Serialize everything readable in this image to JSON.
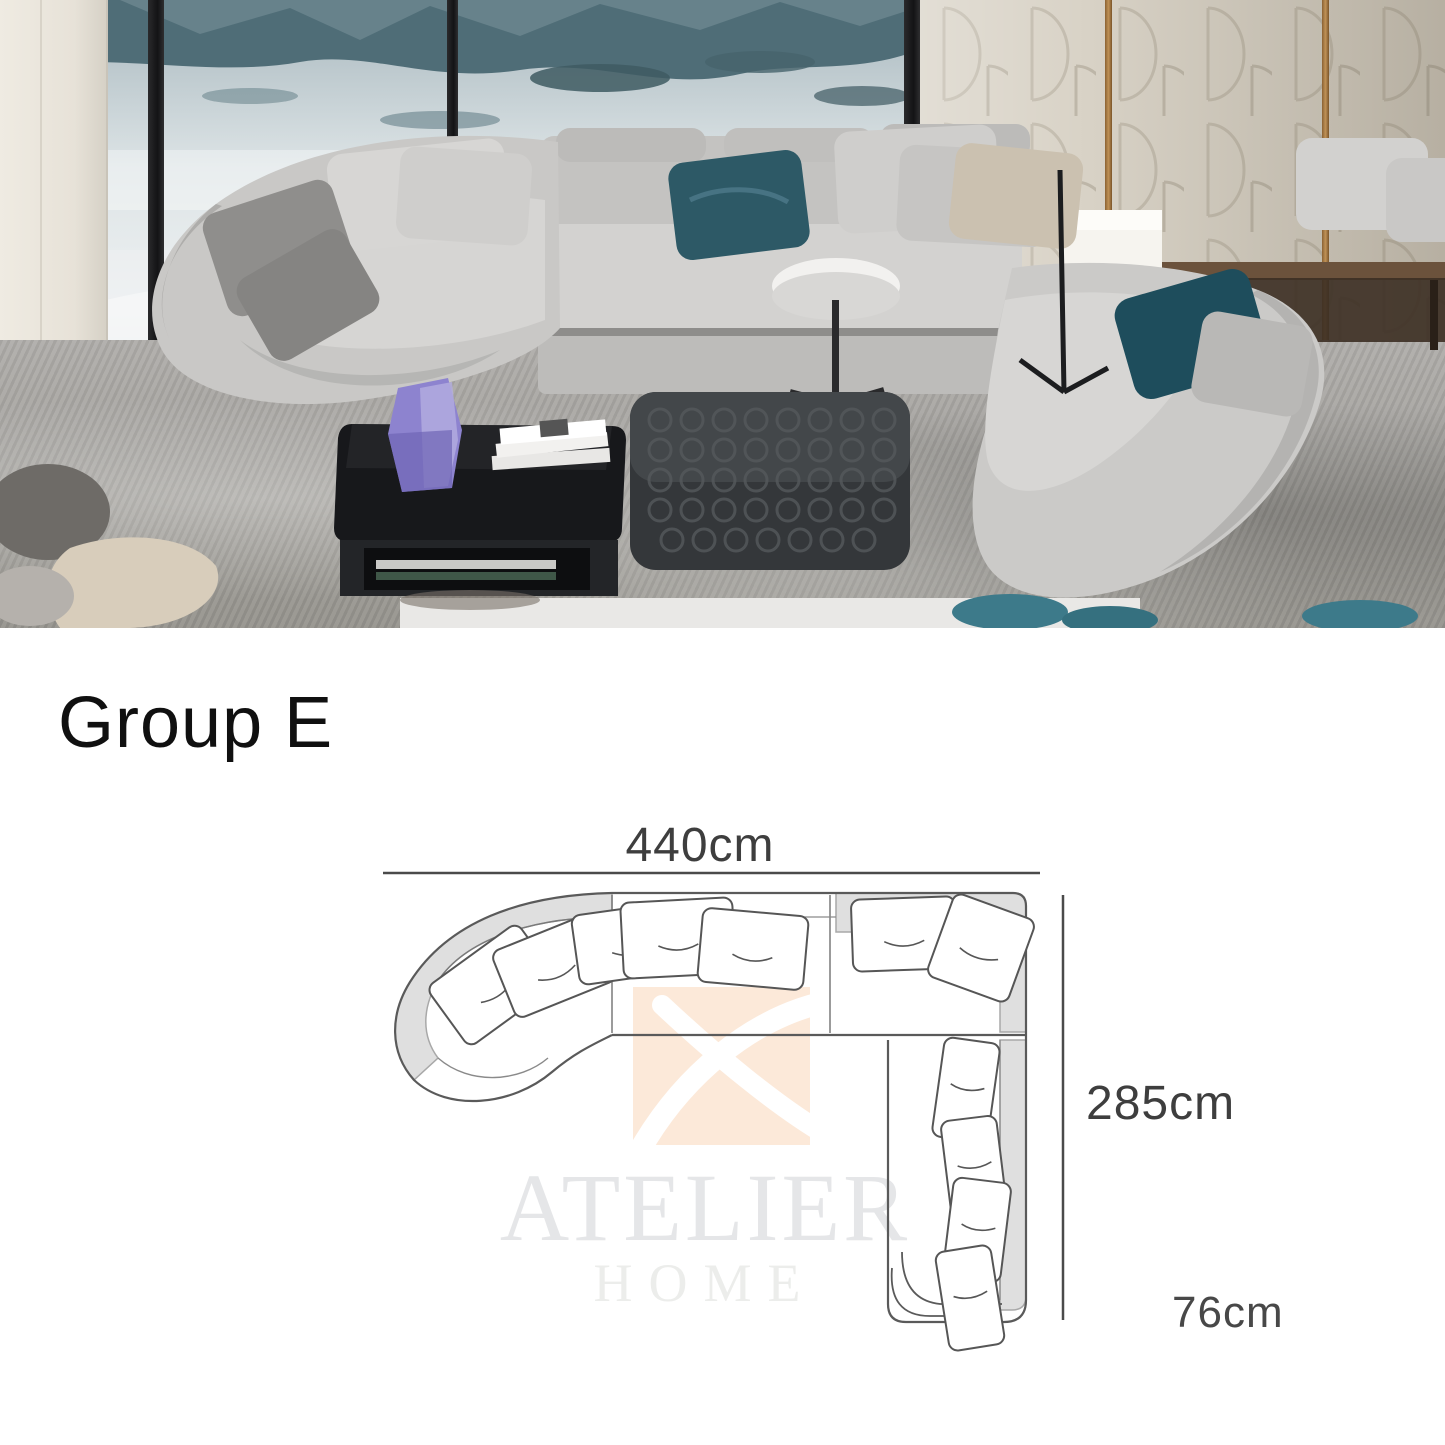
{
  "title": {
    "group_label": "Group E"
  },
  "diagram": {
    "width_label": "440cm",
    "length_label": "285cm",
    "depth_label": "76cm"
  },
  "watermark": {
    "brand": "ATELIER",
    "word": "HOME"
  },
  "palette": {
    "sofa_fabric": "#cbcac8",
    "teal_pillow": "#2d5966",
    "dark_teal_pillow": "#1e4d5c",
    "beige_pillow": "#cbc1b0",
    "wall_panel": "#d9d3c7",
    "rug": "#a3a19e",
    "coffee_table": "#141619",
    "ottoman": "#34373a",
    "watermark_logo_bg": "#fce9d9",
    "watermark_text": "#e5e6e8",
    "dimension_text": "#3e3e3e"
  }
}
